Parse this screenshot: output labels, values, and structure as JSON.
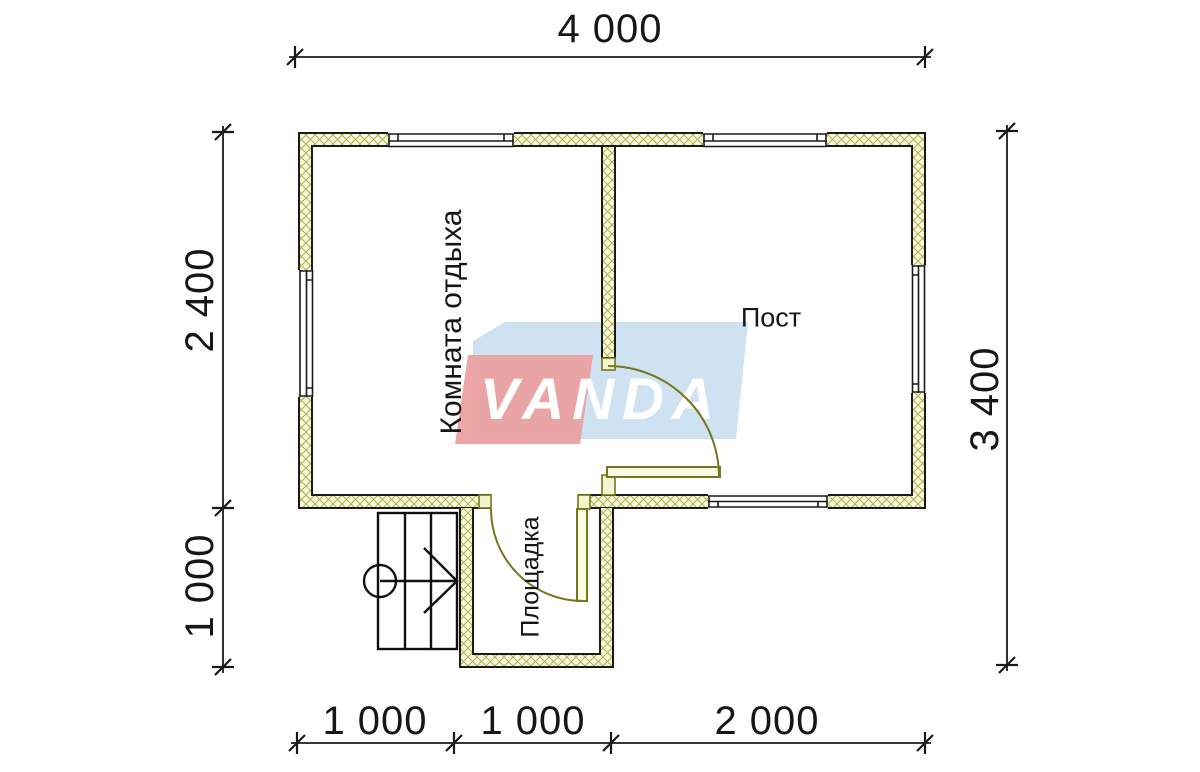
{
  "watermark": {
    "text": "VANDA",
    "banner_blue": "#cfe2f1",
    "banner_red": "#eb9e9e",
    "text_color": "#ffffff"
  },
  "rooms": {
    "rest_room": "Комната отдыха",
    "post_room": "Пост",
    "landing": "Площадка"
  },
  "dimensions": {
    "top": "4 000",
    "left_upper": "2 400",
    "left_lower": "1 000",
    "right": "3 400",
    "bottom_left": "1 000",
    "bottom_middle": "1 000",
    "bottom_right": "2 000"
  },
  "colors": {
    "wall_fill": "#f8f8dd",
    "wall_hatch": "#b2b24c",
    "wall_line": "#1a1a1a",
    "door_line": "#76761c",
    "door_fill": "#fafae2",
    "dimension_line": "#1a1a1a"
  }
}
